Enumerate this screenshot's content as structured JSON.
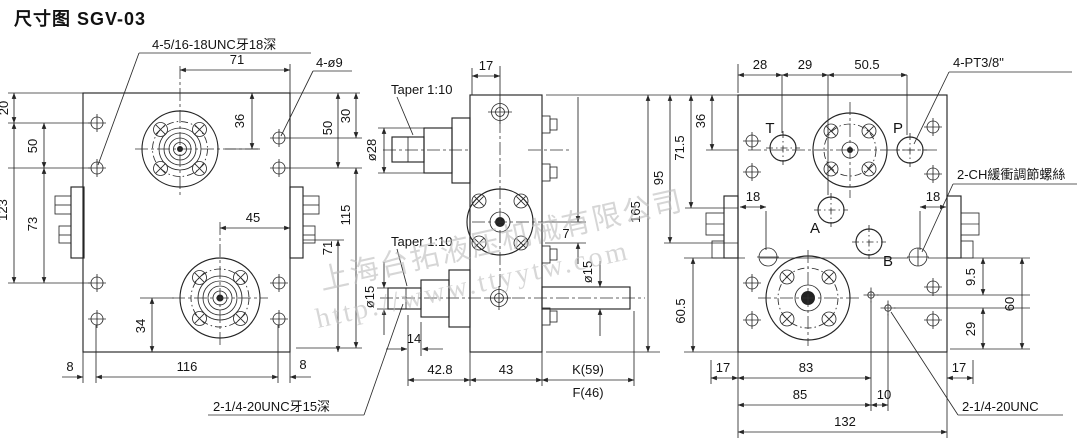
{
  "page": {
    "title": "尺寸图 SGV-03"
  },
  "watermark": {
    "company": "上海台拓液压机械有限公司",
    "url": "http://www.ttyytw.com"
  },
  "front_view": {
    "callout_top": "4-5/16-18UNC牙18深",
    "callout_holes": "4-ø9",
    "callout_bottom": "2-1/4-20UNC牙15深",
    "dims": {
      "top_span": "71",
      "edge_top": "20",
      "left_upper": "50",
      "left_total": "123",
      "left_lower": "73",
      "hub_offset": "36",
      "right_top": "30",
      "right_upper": "50",
      "right_lower": "115",
      "right_bottom": "71",
      "mid_span": "45",
      "lower_hub": "34",
      "bottom_left": "8",
      "bottom_span": "116",
      "bottom_right": "8"
    }
  },
  "side_view": {
    "taper_upper": "Taper 1:10",
    "taper_lower": "Taper 1:10",
    "dia_input": "ø28",
    "dia_out_left": "ø15",
    "dia_out_right": "ø15",
    "dims": {
      "top": "17",
      "face": "7",
      "shaft_step": "14",
      "left_len": "42.8",
      "body_len": "43",
      "shaft_k": "K(59)",
      "shaft_f": "F(46)",
      "height": "165"
    }
  },
  "port_view": {
    "callout_pt": "4-PT3/8\"",
    "callout_ch": "2-CH緩衝調節螺絲",
    "callout_unc": "2-1/4-20UNC",
    "ports": {
      "t": "T",
      "p": "P",
      "a": "A",
      "b": "B"
    },
    "dims": {
      "top1": "28",
      "top2": "29",
      "top3": "50.5",
      "h_hub": "36",
      "h_a": "71.5",
      "h_b": "95",
      "h_low": "60.5",
      "side_left": "18",
      "side_right": "18",
      "r1": "9.5",
      "r2": "60",
      "r3": "29",
      "b17l": "17",
      "b83": "83",
      "b85": "85",
      "b10": "10",
      "b17r": "17",
      "b132": "132"
    }
  }
}
